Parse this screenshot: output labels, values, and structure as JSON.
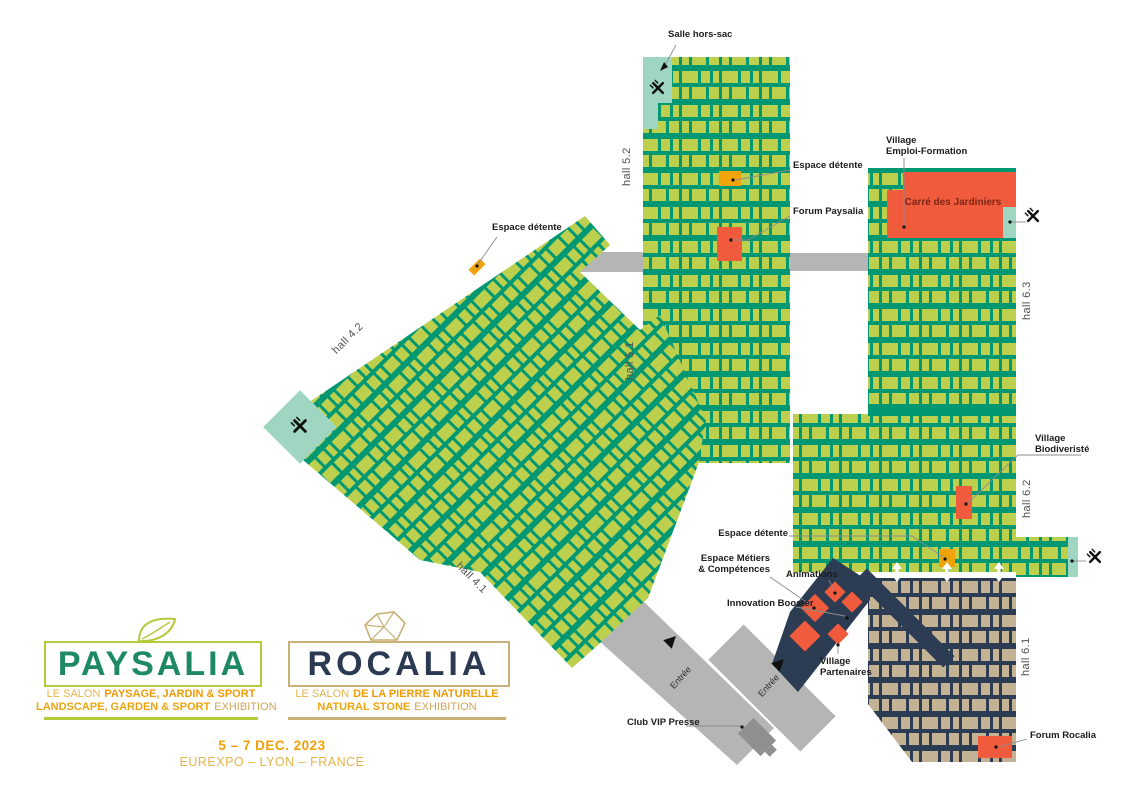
{
  "halls": {
    "h52": "hall 5.2",
    "h51": "hall 5.1",
    "h42": "hall 4.2",
    "h41": "hall 4.1",
    "h63": "hall 6.3",
    "h62": "hall 6.2",
    "h61": "hall 6.1"
  },
  "annotations": {
    "salle_hors_sac": "Salle hors-sac",
    "espace_detente": "Espace détente",
    "forum_paysalia": "Forum Paysalia",
    "village_emploi_line1": "Village",
    "village_emploi_line2": "Emploi-Formation",
    "carre_des_jardiniers": "Carré des Jardiniers",
    "village_bio_line1": "Village",
    "village_bio_line2": "Biodiveristé",
    "espace_metiers_line1": "Espace Métiers",
    "espace_metiers_line2": "& Compétences",
    "animations": "Animations",
    "innovation_booster": "Innovation Booster",
    "village_partenaires_line1": "Village",
    "village_partenaires_line2": "Partenaires",
    "club_vip_presse": "Club VIP Presse",
    "forum_rocalia": "Forum Rocalia",
    "entree": "Entrée"
  },
  "logos": {
    "paysalia": {
      "name": "PAYSALIA",
      "tagline_fr_light": "LE SALON",
      "tagline_fr_bold": "PAYSAGE, JARDIN & SPORT",
      "tagline_en_bold": "LANDSCAPE, GARDEN & SPORT",
      "tagline_en_light": "EXHIBITION"
    },
    "rocalia": {
      "name": "ROCALIA",
      "tagline_fr_light": "LE SALON",
      "tagline_fr_bold": "DE LA PIERRE NATURELLE",
      "tagline_en_bold": "NATURAL STONE",
      "tagline_en_light": "EXHIBITION"
    }
  },
  "event": {
    "dates": "5 – 7 DEC. 2023",
    "venue": "EUREXPO – LYON – FRANCE"
  },
  "icons": {
    "restaurant": "crossed-fork-and-knife",
    "entrance_arrow": "black-triangle-up",
    "transfer_arrow": "white-double-vertical-arrow",
    "paysalia_glyph": "leaf-outline",
    "rocalia_glyph": "stone-outline"
  },
  "colors": {
    "hall_teal": "#009873",
    "booth_green": "#bcd04e",
    "hall_navy": "#2b3c53",
    "booth_tan": "#c4b294",
    "highlight_orange": "#f15b3d",
    "highlight_amber": "#f0a30b",
    "restaurant_teal": "#9ed6c2",
    "corridor_gray": "#b5b5b5",
    "club_vip_gray": "#8f8f8f",
    "paysalia_green": "#1d8a63",
    "paysalia_lime": "#b5c93b",
    "rocalia_navy": "#2b3a52",
    "rocalia_tan": "#c8b077",
    "accent_gold": "#f2a007"
  }
}
